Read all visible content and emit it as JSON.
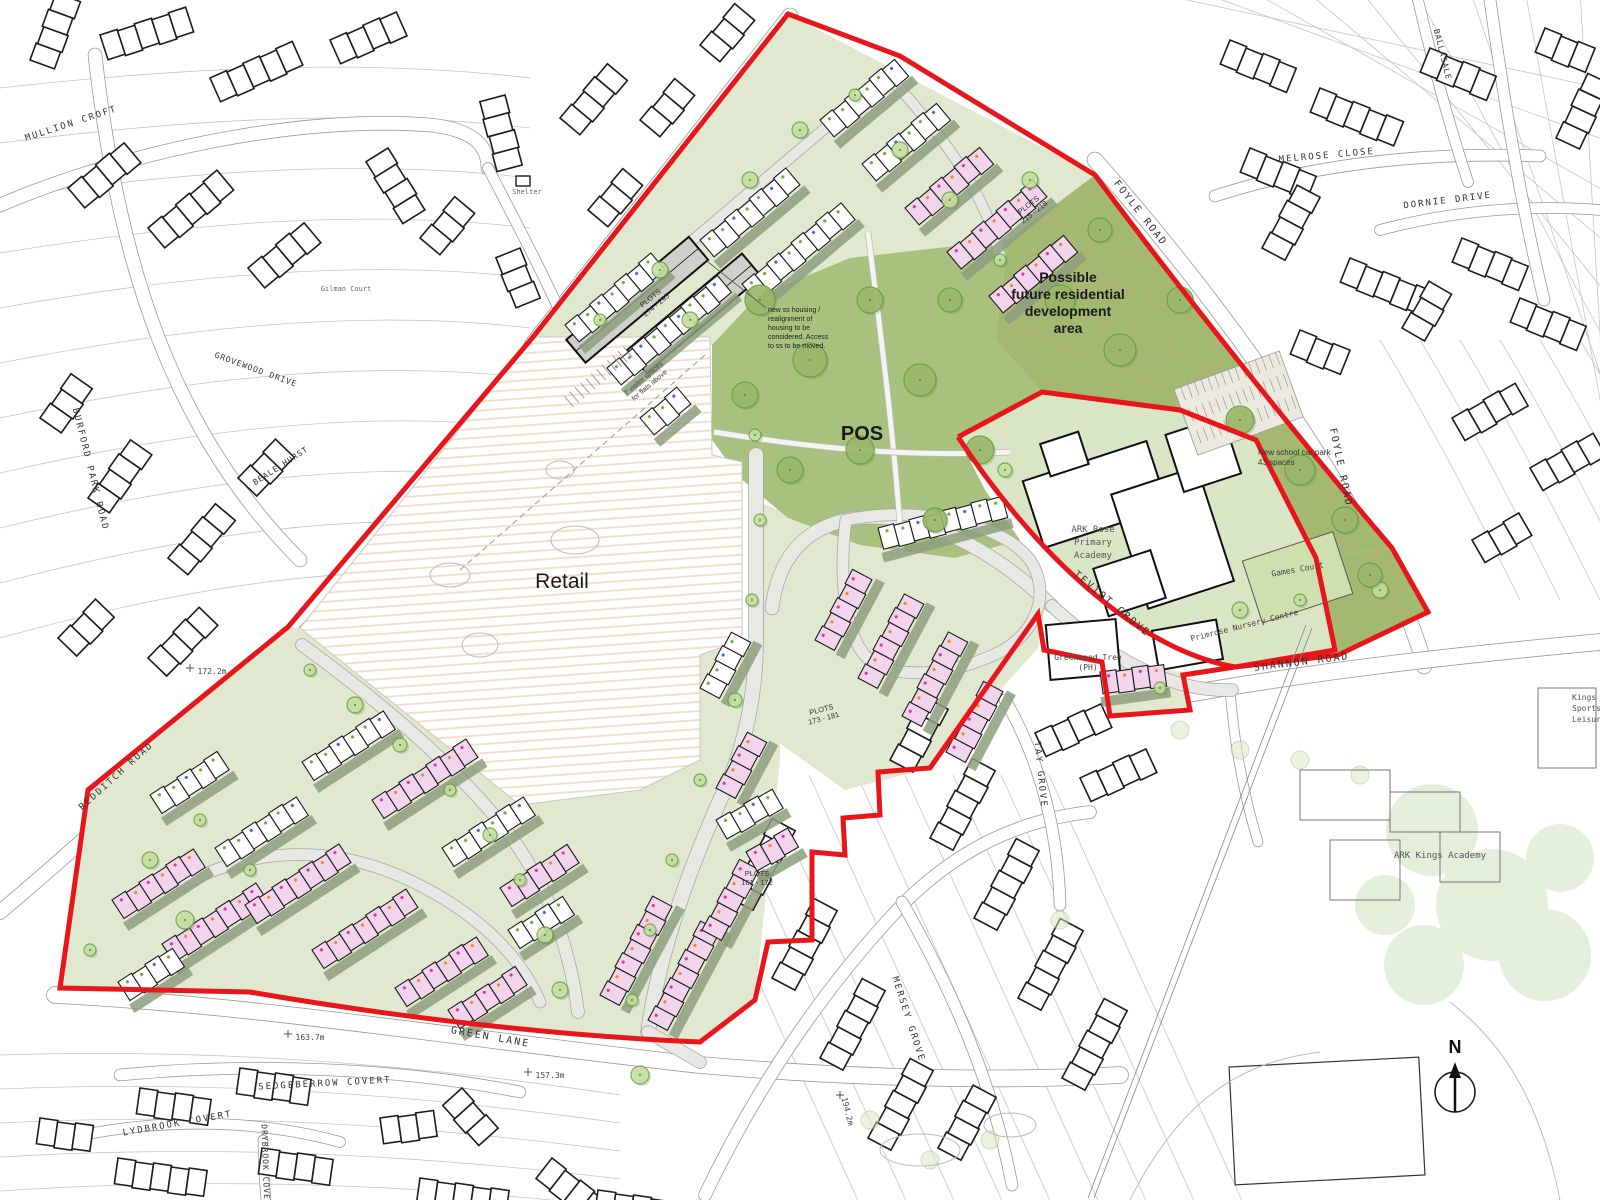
{
  "colors": {
    "boundary_red": "#e8151b",
    "pos_green": "#a9c17e",
    "future_green": "#a3b972",
    "school_green": "#d9e6c6",
    "games_court_green": "#cde0ae",
    "garden_green": "#e0e9cf",
    "sage_green": "#8d9e7d",
    "road_grey": "#e8e8e4",
    "road_casing": "#a9a9a4",
    "ctx_road_casing": "#9a9a9a",
    "retail_hatch": "#f3ddc5",
    "pink_house": "#f3d4ed",
    "white_house": "#ffffff",
    "flats_grey": "#d0d0ca",
    "tree_fill": "#c8dfa0",
    "tree_ring": "#5fa243",
    "big_tree_fill": "#9cb86b",
    "grid_orange": "#dda05e",
    "context_line": "#1c1c1c",
    "parcel_line": "#c6c6c6",
    "dot_magenta": "#e0379f",
    "dot_orange": "#f08c1e",
    "dot_green": "#6fae3b",
    "dot_blue": "#3f6bd6"
  },
  "house_type_codes": [
    "2A",
    "2B",
    "2C",
    "2D",
    "3A",
    "4A",
    "4C"
  ],
  "north_arrow": {
    "label": "N"
  },
  "labels": [
    {
      "id": "retail-area-label",
      "lines": [
        "Retail"
      ],
      "x": 562,
      "y": 588,
      "size": 21,
      "c": "#1a1a1a",
      "f": "s"
    },
    {
      "id": "pos-area-label",
      "lines": [
        "POS"
      ],
      "x": 862,
      "y": 440,
      "size": 20,
      "w": "bold",
      "f": "s",
      "c": "#1a1a1a"
    },
    {
      "id": "future-area-label",
      "lines": [
        "Possible",
        "future residential",
        "development",
        "area"
      ],
      "x": 1068,
      "y": 282,
      "size": 14,
      "w": "bold",
      "f": "s",
      "c": "#1a1a1a",
      "lh": 17
    },
    {
      "id": "ark-rose-academy-label",
      "lines": [
        "ARK Rose",
        "Primary",
        "Academy"
      ],
      "x": 1093,
      "y": 532,
      "size": 9,
      "c": "#555555",
      "f": "m",
      "lh": 13
    },
    {
      "id": "primrose-nursery-label",
      "lines": [
        "Primrose Nursery Centre"
      ],
      "x": 1245,
      "y": 628,
      "rot": -14,
      "size": 8,
      "c": "#444444",
      "f": "m"
    },
    {
      "id": "games-court-label",
      "lines": [
        "Games Court"
      ],
      "x": 1298,
      "y": 572,
      "rot": -10,
      "size": 8,
      "c": "#444444",
      "f": "m"
    },
    {
      "id": "greenwood-tree-label",
      "lines": [
        "Greenwood Tree",
        "(PH)"
      ],
      "x": 1088,
      "y": 660,
      "size": 8,
      "c": "#444444",
      "f": "m",
      "lh": 10
    },
    {
      "id": "car-park-note",
      "lines": [
        "New school car park",
        "43 spaces"
      ],
      "x": 1258,
      "y": 455,
      "size": 8,
      "c": "#333333",
      "f": "s",
      "anchor": "start",
      "lh": 10
    },
    {
      "id": "plots-274-295-label",
      "lines": [
        "PLOTS",
        "274 - 295"
      ],
      "x": 652,
      "y": 300,
      "rot": -40,
      "size": 7.5,
      "c": "#333333",
      "f": "s",
      "lh": 9
    },
    {
      "id": "plots-215-218-label",
      "lines": [
        "PLOTS",
        "215 - 218"
      ],
      "x": 1030,
      "y": 207,
      "rot": -38,
      "size": 7.5,
      "c": "#333333",
      "f": "s",
      "lh": 9
    },
    {
      "id": "plots-173-181-label",
      "lines": [
        "PLOTS",
        "173 - 181"
      ],
      "x": 822,
      "y": 712,
      "rot": -15,
      "size": 7.5,
      "c": "#333333",
      "f": "s",
      "lh": 9
    },
    {
      "id": "plots-161-172-label",
      "lines": [
        "PLOTS",
        "161 - 172"
      ],
      "x": 757,
      "y": 876,
      "size": 7.5,
      "c": "#333333",
      "f": "s",
      "lh": 9
    },
    {
      "id": "housing-realignment-note",
      "lines": [
        "new ss housing /",
        "realignment of",
        "housing to be",
        "considered. Access",
        "to ss to be moved."
      ],
      "x": 768,
      "y": 312,
      "size": 7,
      "c": "#222222",
      "f": "s",
      "anchor": "start",
      "lh": 9
    },
    {
      "id": "visitor-spaces-note",
      "lines": [
        "7 visitor spaces",
        "for flats above"
      ],
      "x": 645,
      "y": 380,
      "rot": -40,
      "size": 7,
      "c": "#444444",
      "f": "s",
      "lh": 9
    },
    {
      "id": "shelter-label",
      "lines": [
        "Shelter"
      ],
      "x": 527,
      "y": 194,
      "size": 7,
      "c": "#666666",
      "f": "m"
    },
    {
      "id": "gilman-court-label",
      "lines": [
        "Gilman Court"
      ],
      "x": 346,
      "y": 291,
      "size": 7,
      "c": "#666666",
      "f": "m"
    },
    {
      "id": "ark-kings-academy-label",
      "lines": [
        "ARK Kings Academy"
      ],
      "x": 1440,
      "y": 858,
      "size": 9,
      "c": "#555555",
      "f": "m"
    },
    {
      "id": "leisure-centre-label",
      "lines": [
        "Kings Norton",
        "Sports and",
        "Leisure Centre"
      ],
      "x": 1572,
      "y": 700,
      "size": 8,
      "c": "#555555",
      "f": "m",
      "anchor": "start",
      "lh": 11
    },
    {
      "id": "foyle-road-label-1",
      "lines": [
        "FOYLE ROAD"
      ],
      "x": 1138,
      "y": 215,
      "rot": 52,
      "size": 10,
      "c": "#333333",
      "f": "m",
      "ls": 2
    },
    {
      "id": "foyle-road-label-2",
      "lines": [
        "FOYLE ROAD"
      ],
      "x": 1338,
      "y": 468,
      "rot": 78,
      "size": 10,
      "c": "#333333",
      "f": "m",
      "ls": 2
    },
    {
      "id": "shannon-road-label",
      "lines": [
        "SHANNON ROAD"
      ],
      "x": 1302,
      "y": 665,
      "rot": -7,
      "size": 10,
      "c": "#333333",
      "f": "m",
      "ls": 2
    },
    {
      "id": "teviot-grove-label",
      "lines": [
        "TEVIOT GROVE"
      ],
      "x": 1110,
      "y": 606,
      "rot": 40,
      "size": 10,
      "c": "#333333",
      "f": "m",
      "ls": 2
    },
    {
      "id": "tay-grove-label",
      "lines": [
        "TAY GROVE"
      ],
      "x": 1038,
      "y": 775,
      "rot": 84,
      "size": 9,
      "c": "#333333",
      "f": "m",
      "ls": 2
    },
    {
      "id": "mersey-grove-label",
      "lines": [
        "MERSEY GROVE"
      ],
      "x": 906,
      "y": 1020,
      "rot": 72,
      "size": 9,
      "c": "#333333",
      "f": "m",
      "ls": 2
    },
    {
      "id": "green-lane-label",
      "lines": [
        "GREEN LANE"
      ],
      "x": 490,
      "y": 1040,
      "rot": 10,
      "size": 10,
      "c": "#333333",
      "f": "m",
      "ls": 2
    },
    {
      "id": "redditch-road-label",
      "lines": [
        "REDDITCH ROAD"
      ],
      "x": 118,
      "y": 778,
      "rot": -42,
      "size": 9,
      "c": "#333333",
      "f": "m",
      "ls": 2
    },
    {
      "id": "burford-park-road-label",
      "lines": [
        "BURFORD PARK ROAD"
      ],
      "x": 88,
      "y": 470,
      "rot": 76,
      "size": 9,
      "c": "#333333",
      "f": "m",
      "ls": 2
    },
    {
      "id": "mullion-croft-label",
      "lines": [
        "MULLION CROFT"
      ],
      "x": 72,
      "y": 126,
      "rot": -18,
      "size": 9,
      "c": "#333333",
      "f": "m",
      "ls": 2
    },
    {
      "id": "melrose-close-label",
      "lines": [
        "MELROSE CLOSE"
      ],
      "x": 1327,
      "y": 158,
      "rot": -5,
      "size": 9,
      "c": "#333333",
      "f": "m",
      "ls": 2
    },
    {
      "id": "dornie-drive-label",
      "lines": [
        "DORNIE DRIVE"
      ],
      "x": 1448,
      "y": 203,
      "rot": -7,
      "size": 9,
      "c": "#333333",
      "f": "m",
      "ls": 2
    },
    {
      "id": "ballasale-label",
      "lines": [
        "BALLASALE"
      ],
      "x": 1440,
      "y": 55,
      "rot": 76,
      "size": 8,
      "c": "#333333",
      "f": "m",
      "ls": 1
    },
    {
      "id": "sedgeberrow-covert-label",
      "lines": [
        "SEDGEBERROW COVERT"
      ],
      "x": 325,
      "y": 1086,
      "rot": -3,
      "size": 9,
      "c": "#333333",
      "f": "m",
      "ls": 2
    },
    {
      "id": "lydbrook-covert-label",
      "lines": [
        "LYDBROOK COVERT"
      ],
      "x": 178,
      "y": 1126,
      "rot": -10,
      "size": 9,
      "c": "#333333",
      "f": "m",
      "ls": 2
    },
    {
      "id": "drybrook-covert-label",
      "lines": [
        "DRYBROOK COVERT"
      ],
      "x": 263,
      "y": 1168,
      "rot": 88,
      "size": 8,
      "c": "#333333",
      "f": "m",
      "ls": 1
    },
    {
      "id": "beale-hurst-label",
      "lines": [
        "BEALE HURST"
      ],
      "x": 282,
      "y": 468,
      "rot": -33,
      "size": 8,
      "c": "#333333",
      "f": "m",
      "ls": 1
    },
    {
      "id": "grovewood-drive-label",
      "lines": [
        "GROVEWOOD DRIVE"
      ],
      "x": 255,
      "y": 372,
      "rot": 20,
      "size": 8,
      "c": "#333333",
      "f": "m",
      "ls": 1
    },
    {
      "id": "spot-height-172",
      "lines": [
        "172.2m"
      ],
      "x": 212,
      "y": 674,
      "size": 8,
      "c": "#444444",
      "f": "m",
      "tick": [
        190,
        668
      ]
    },
    {
      "id": "spot-height-163",
      "lines": [
        "163.7m"
      ],
      "x": 310,
      "y": 1040,
      "size": 8,
      "c": "#444444",
      "f": "m",
      "tick": [
        288,
        1034
      ]
    },
    {
      "id": "spot-height-157",
      "lines": [
        "157.3m"
      ],
      "x": 550,
      "y": 1078,
      "size": 8,
      "c": "#444444",
      "f": "m",
      "tick": [
        528,
        1072
      ]
    },
    {
      "id": "spot-height-194",
      "lines": [
        "194.2m"
      ],
      "x": 845,
      "y": 1112,
      "rot": 76,
      "size": 8,
      "c": "#444444",
      "f": "m",
      "tick": [
        840,
        1095
      ]
    },
    {
      "id": "north-label",
      "lines": [
        "N"
      ],
      "x": 1455,
      "y": 1053,
      "size": 18,
      "w": "bold",
      "f": "s",
      "c": "#111111"
    }
  ]
}
